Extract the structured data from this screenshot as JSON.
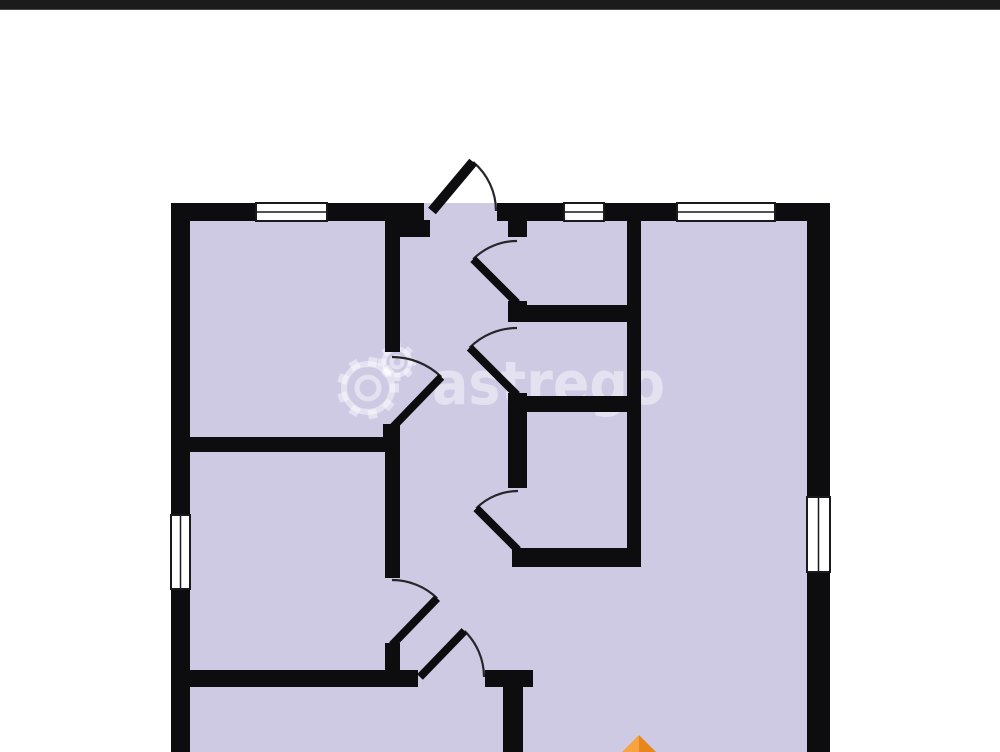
{
  "scene": {
    "width": 1000,
    "height": 752,
    "background": "#ffffff",
    "top_bar": {
      "height": 10,
      "color": "#1b1b1b",
      "edge_color": "#4a4a4a"
    }
  },
  "palette": {
    "floor": "#cecae3",
    "wall": "#0d0d0f",
    "window_fill": "#ffffff",
    "window_frame": "#1a1a1c",
    "door_arc": "#26262a",
    "door_leaf": "#0d0d0f"
  },
  "floorplan": {
    "floor_rect": {
      "x": 171,
      "y": 203,
      "w": 659,
      "h": 549
    },
    "walls": [
      {
        "name": "outer-top-1",
        "x": 171,
        "y": 203,
        "w": 85,
        "h": 18
      },
      {
        "name": "outer-top-2",
        "x": 327,
        "y": 203,
        "w": 97,
        "h": 18
      },
      {
        "name": "outer-top-3",
        "x": 497,
        "y": 203,
        "w": 67,
        "h": 18
      },
      {
        "name": "outer-top-4",
        "x": 604,
        "y": 203,
        "w": 73,
        "h": 18
      },
      {
        "name": "outer-top-5",
        "x": 775,
        "y": 203,
        "w": 55,
        "h": 18
      },
      {
        "name": "outer-left-upper",
        "x": 171,
        "y": 203,
        "w": 19,
        "h": 312
      },
      {
        "name": "outer-left-lower",
        "x": 171,
        "y": 589,
        "w": 19,
        "h": 163
      },
      {
        "name": "outer-right-upper",
        "x": 807,
        "y": 203,
        "w": 23,
        "h": 294
      },
      {
        "name": "outer-right-lower",
        "x": 807,
        "y": 572,
        "w": 23,
        "h": 180
      },
      {
        "name": "entry-left-jamb",
        "x": 385,
        "y": 220,
        "w": 45,
        "h": 17
      },
      {
        "name": "bedroom1-right-wall",
        "x": 385,
        "y": 220,
        "w": 15,
        "h": 132
      },
      {
        "name": "bedroom1-door-stub",
        "x": 383,
        "y": 424,
        "w": 17,
        "h": 28
      },
      {
        "name": "divider-left-h1",
        "x": 190,
        "y": 437,
        "w": 210,
        "h": 15
      },
      {
        "name": "bedroom2-right-wall",
        "x": 385,
        "y": 452,
        "w": 15,
        "h": 126
      },
      {
        "name": "bedroom2-door-stub",
        "x": 385,
        "y": 643,
        "w": 15,
        "h": 29
      },
      {
        "name": "divider-left-h2",
        "x": 190,
        "y": 670,
        "w": 228,
        "h": 17
      },
      {
        "name": "divider-left-h2b",
        "x": 485,
        "y": 670,
        "w": 48,
        "h": 17
      },
      {
        "name": "bottom-room-right-wall",
        "x": 503,
        "y": 687,
        "w": 20,
        "h": 65
      },
      {
        "name": "entry-right-stub",
        "x": 508,
        "y": 220,
        "w": 19,
        "h": 17
      },
      {
        "name": "wc-door-stub",
        "x": 508,
        "y": 301,
        "w": 19,
        "h": 21
      },
      {
        "name": "wc-bottom-wall",
        "x": 508,
        "y": 305,
        "w": 133,
        "h": 17
      },
      {
        "name": "bath-door-stub",
        "x": 508,
        "y": 393,
        "w": 19,
        "h": 19
      },
      {
        "name": "bath-bottom-wall",
        "x": 508,
        "y": 396,
        "w": 133,
        "h": 16
      },
      {
        "name": "storage-left-wall",
        "x": 508,
        "y": 412,
        "w": 19,
        "h": 76
      },
      {
        "name": "storage-bottom-wall",
        "x": 512,
        "y": 548,
        "w": 129,
        "h": 19
      },
      {
        "name": "living-left-wall",
        "x": 627,
        "y": 220,
        "w": 14,
        "h": 347
      }
    ],
    "windows": [
      {
        "name": "window-top-left",
        "x": 256,
        "y": 203,
        "w": 71,
        "h": 18,
        "inner_lines": 1
      },
      {
        "name": "window-top-middle",
        "x": 564,
        "y": 203,
        "w": 40,
        "h": 18,
        "inner_lines": 1
      },
      {
        "name": "window-top-right",
        "x": 677,
        "y": 203,
        "w": 98,
        "h": 18,
        "inner_lines": 1
      },
      {
        "name": "window-left",
        "x": 171,
        "y": 515,
        "w": 19,
        "h": 74,
        "inner_lines": 1
      },
      {
        "name": "window-right",
        "x": 807,
        "y": 497,
        "w": 23,
        "h": 75,
        "inner_lines": 1
      }
    ],
    "doors": [
      {
        "name": "entrance-door",
        "hinge": [
          432,
          211
        ],
        "radius": 64,
        "closed_deg": 0,
        "open_deg": -50,
        "leaf_width": 10
      },
      {
        "name": "wc-door",
        "hinge": [
          517,
          303
        ],
        "radius": 62,
        "closed_deg": -90,
        "open_deg": -135,
        "leaf_width": 8
      },
      {
        "name": "bath-door",
        "hinge": [
          517,
          395
        ],
        "radius": 67,
        "closed_deg": -90,
        "open_deg": -135,
        "leaf_width": 8
      },
      {
        "name": "storage-door",
        "hinge": [
          518,
          550
        ],
        "radius": 59,
        "closed_deg": -90,
        "open_deg": -135,
        "leaf_width": 8
      },
      {
        "name": "bedroom1-door",
        "hinge": [
          392,
          428
        ],
        "radius": 71,
        "closed_deg": -90,
        "open_deg": -46,
        "leaf_width": 8
      },
      {
        "name": "bedroom2-door",
        "hinge": [
          392,
          645
        ],
        "radius": 65,
        "closed_deg": -90,
        "open_deg": -46,
        "leaf_width": 8
      },
      {
        "name": "bottom-room-door",
        "hinge": [
          420,
          677
        ],
        "radius": 64,
        "closed_deg": 0,
        "open_deg": -46,
        "leaf_width": 8
      }
    ]
  },
  "watermark": {
    "text": "astrego",
    "text_x": 432,
    "text_y": 404,
    "font_size": 60,
    "text_length": 233,
    "color": "rgba(255,255,255,0.45)",
    "gears": [
      {
        "cx": 368,
        "cy": 388,
        "body_r": 24,
        "teeth_outer_r": 31,
        "hole_r": 11,
        "teeth": 9,
        "stroke": 6,
        "tooth_stroke": 9
      },
      {
        "cx": 397,
        "cy": 362,
        "body_r": 13,
        "teeth_outer_r": 19,
        "hole_r": 5.5,
        "teeth": 8,
        "stroke": 5,
        "tooth_stroke": 7
      }
    ]
  },
  "north_marker": {
    "apex": [
      639,
      735
    ],
    "base_y": 752,
    "half_width": 17,
    "left_color": "#f7a440",
    "right_color": "#e8861d"
  }
}
